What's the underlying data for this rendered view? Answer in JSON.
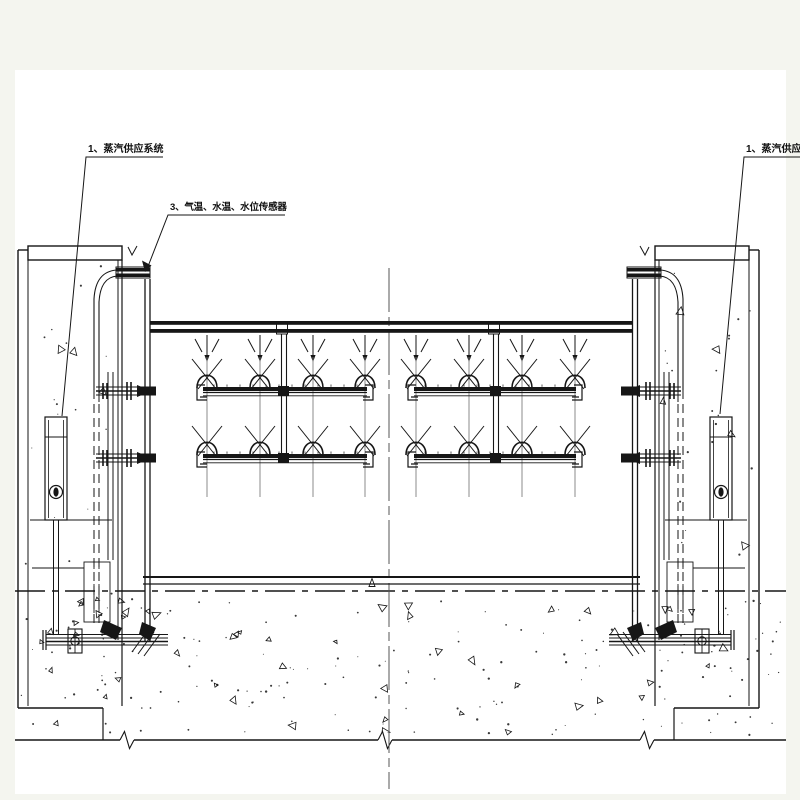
{
  "callouts": {
    "steam_supply_left": "1、蒸汽供应系统",
    "sensors": "3、气温、水温、水位传感器",
    "steam_supply_right": "1、蒸汽供应系统"
  },
  "colors": {
    "paper": "#f4f5ef",
    "canvas": "#ffffff",
    "ink": "#161616",
    "grid": "#777777",
    "centerline": "#555555"
  }
}
